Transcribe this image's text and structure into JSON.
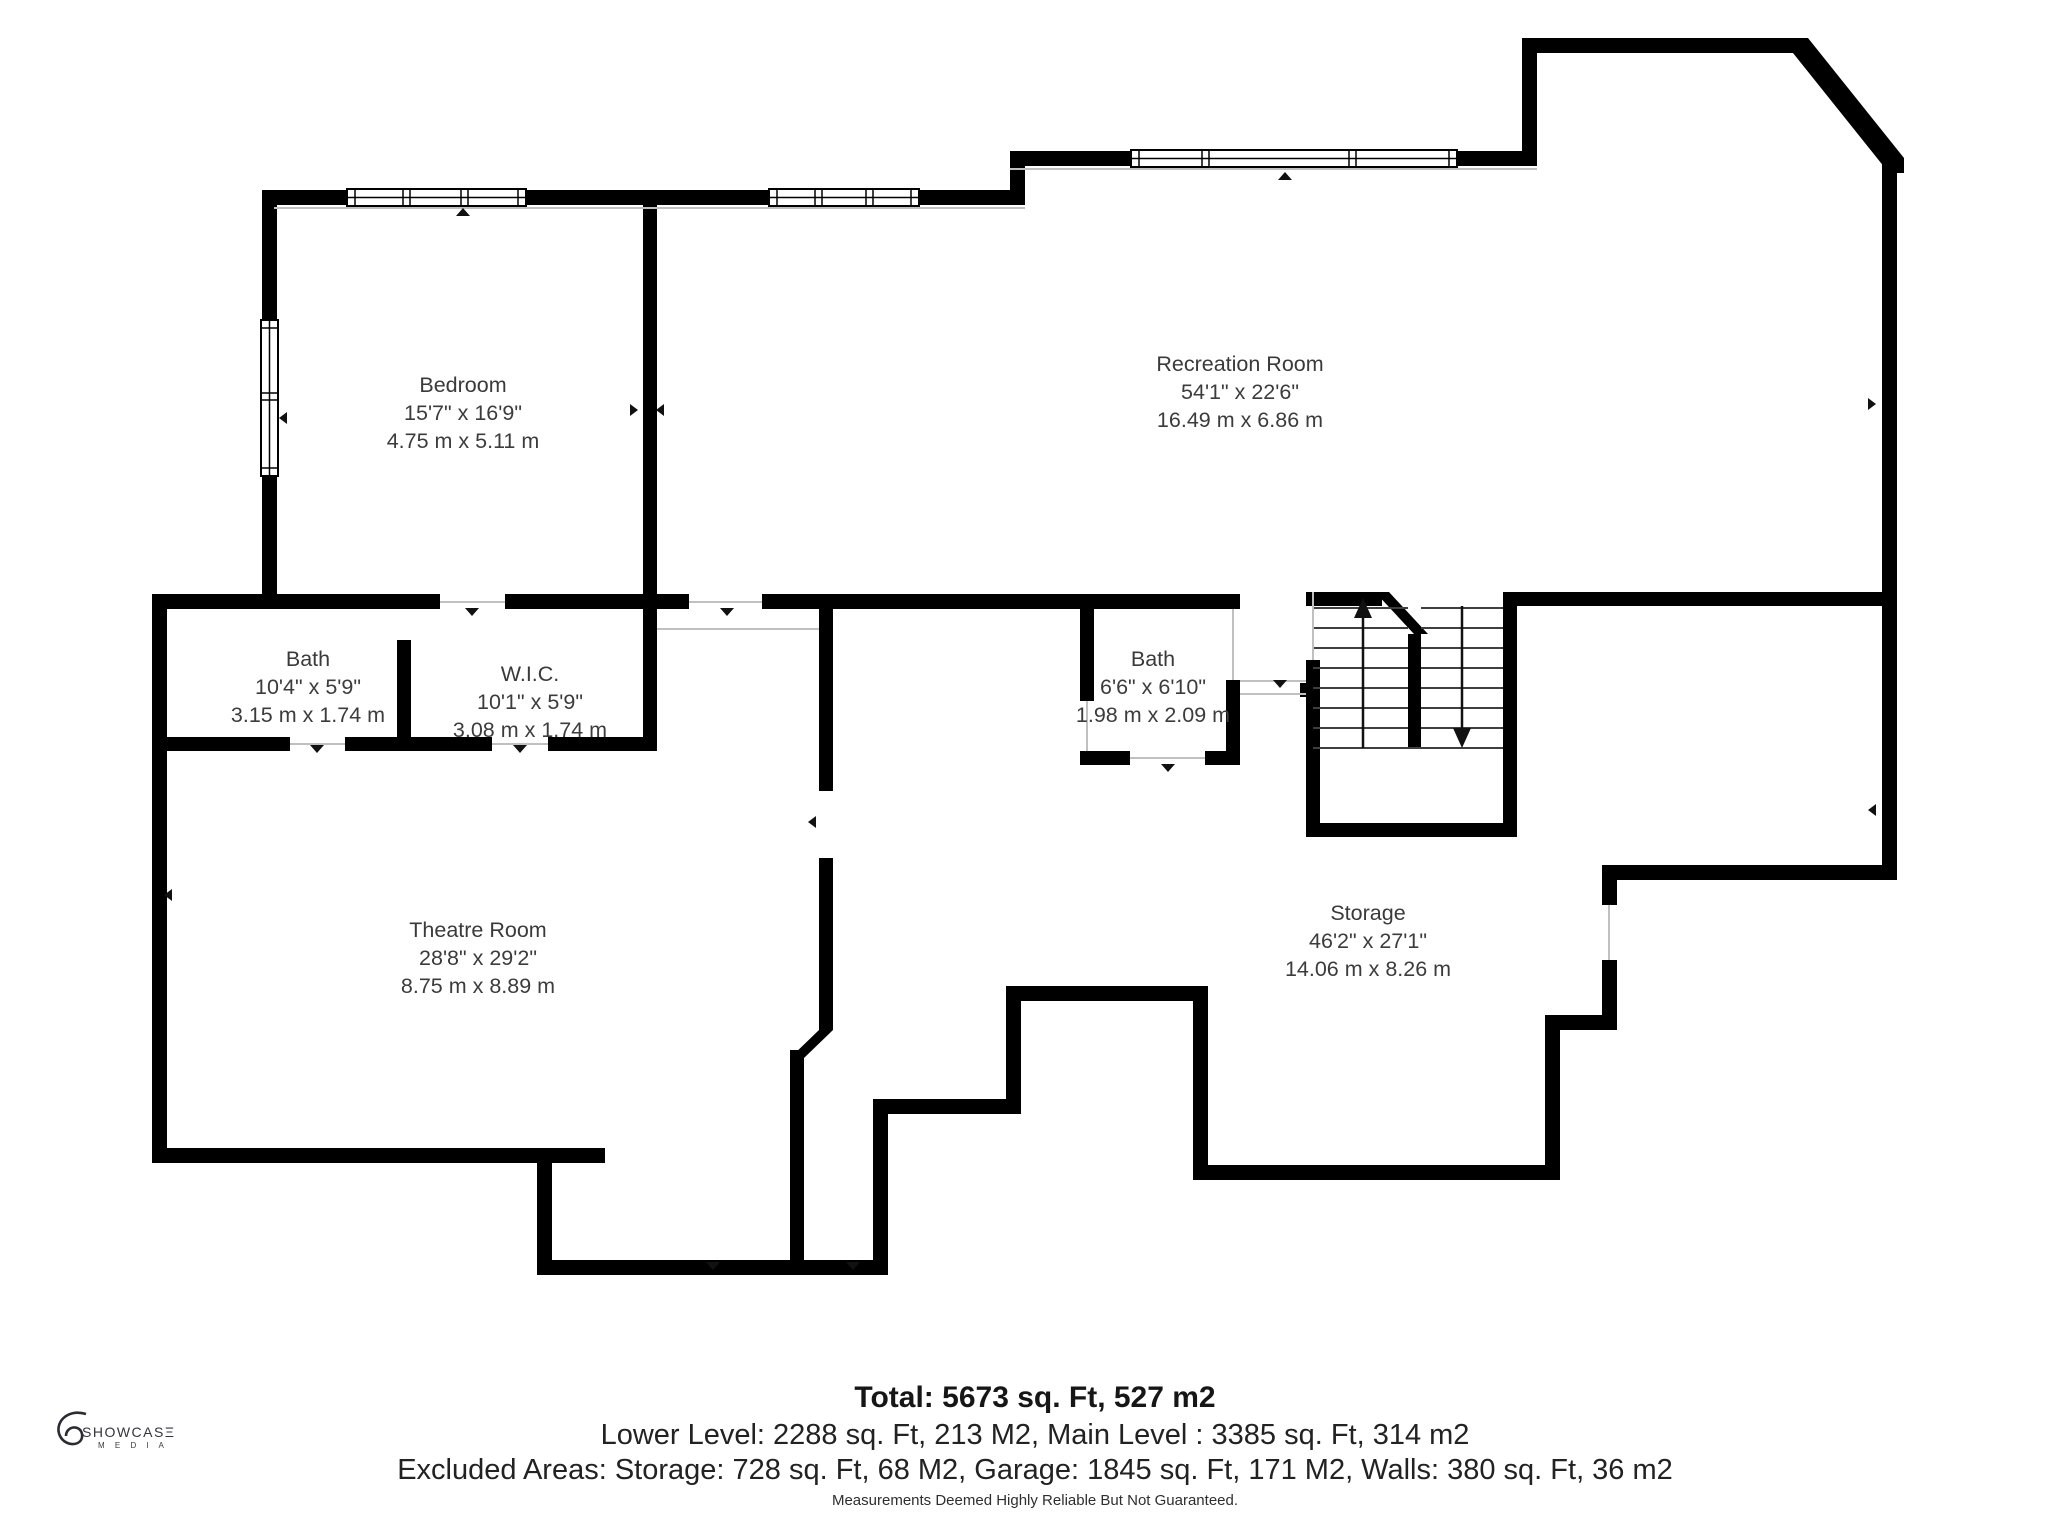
{
  "colors": {
    "wall": "#000000",
    "thin_line": "#c0c0c0",
    "tread": "#3f3f3f",
    "text": "#3c3c3c"
  },
  "rooms": [
    {
      "id": "bedroom",
      "name": "Bedroom",
      "dims_ft": "15'7\" x 16'9\"",
      "dims_m": "4.75 m x 5.11 m",
      "cx": 463,
      "cy": 413
    },
    {
      "id": "recreation-room",
      "name": "Recreation Room",
      "dims_ft": "54'1\" x 22'6\"",
      "dims_m": "16.49 m x 6.86 m",
      "cx": 1240,
      "cy": 392
    },
    {
      "id": "bath",
      "name": "Bath",
      "dims_ft": "10'4\" x 5'9\"",
      "dims_m": "3.15 m x 1.74 m",
      "cx": 308,
      "cy": 687
    },
    {
      "id": "wic",
      "name": "W.I.C.",
      "dims_ft": "10'1\" x 5'9\"",
      "dims_m": "3.08 m x 1.74 m",
      "cx": 530,
      "cy": 702
    },
    {
      "id": "bath-2",
      "name": "Bath",
      "dims_ft": "6'6\" x 6'10\"",
      "dims_m": "1.98 m x 2.09 m",
      "cx": 1153,
      "cy": 687
    },
    {
      "id": "theatre-room",
      "name": "Theatre Room",
      "dims_ft": "28'8\" x 29'2\"",
      "dims_m": "8.75 m x 8.89 m",
      "cx": 478,
      "cy": 958
    },
    {
      "id": "storage",
      "name": "Storage",
      "dims_ft": "46'2\" x 27'1\"",
      "dims_m": "14.06 m x 8.26 m",
      "cx": 1368,
      "cy": 941
    }
  ],
  "summary": {
    "total": "Total: 5673 sq. Ft, 527 m2",
    "levels": "Lower Level: 2288 sq. Ft, 213 M2, Main Level : 3385 sq. Ft, 314 m2",
    "excluded": "Excluded Areas: Storage: 728 sq. Ft, 68 M2, Garage: 1845 sq. Ft, 171 M2, Walls: 380 sq. Ft, 36 m2",
    "disclaimer": "Measurements Deemed Highly Reliable But Not Guaranteed."
  },
  "logo": {
    "brand": "SHOWCASΞ",
    "sub": "M E D I A"
  }
}
